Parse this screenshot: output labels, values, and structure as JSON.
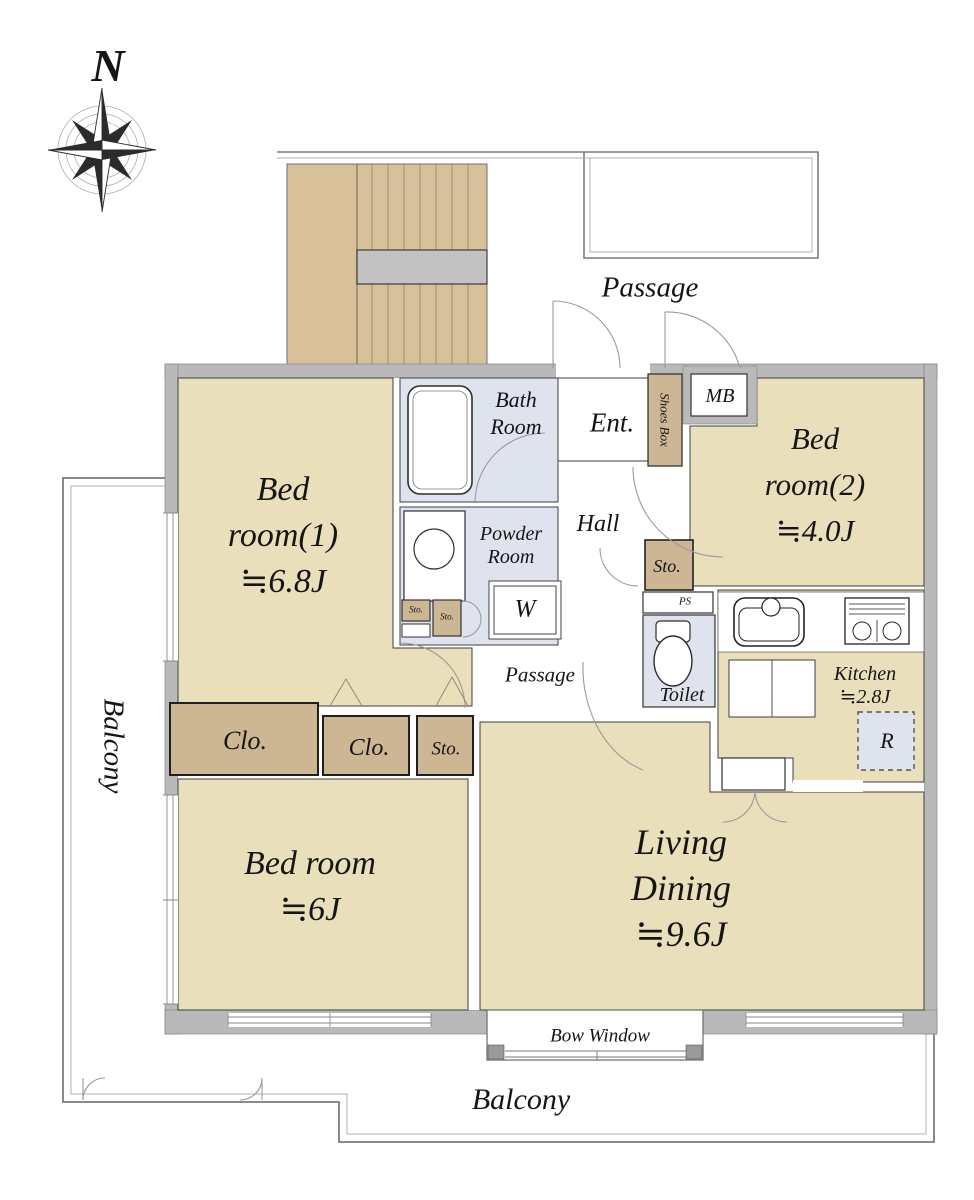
{
  "compass": {
    "north": "N"
  },
  "common": {
    "passage": "Passage",
    "balcony": "Balcony",
    "bow_window": "Bow Window"
  },
  "rooms": {
    "bedroom1": {
      "l1": "Bed",
      "l2": "room(1)",
      "size": "≒6.8J"
    },
    "bedroom2": {
      "l1": "Bed",
      "l2": "room(2)",
      "size": "≒4.0J"
    },
    "bedroom3": {
      "l1": "Bed room",
      "size": "≒6J"
    },
    "living": {
      "l1": "Living",
      "l2": "Dining",
      "size": "≒9.6J"
    },
    "kitchen": {
      "l1": "Kitchen",
      "size": "≒2.8J"
    },
    "bath": {
      "l1": "Bath",
      "l2": "Room"
    },
    "powder": {
      "l1": "Powder",
      "l2": "Room"
    },
    "toilet": "Toilet",
    "hall": "Hall",
    "entrance": "Ent.",
    "inner_passage": "Passage"
  },
  "fixtures": {
    "meter_box": "MB",
    "pipe_space": "PS",
    "washer": "W",
    "refrigerator": "R",
    "shoes_box": "Shoes Box",
    "closet": "Clo.",
    "storage": "Sto."
  },
  "colors": {
    "room_floor": "#e9dfba",
    "stair_floor": "#d8c09a",
    "closet_fill": "#cdb694",
    "wet_area": "#dfe3ee",
    "wall": "#b9b9b9",
    "landing": "#c2c2c2"
  }
}
